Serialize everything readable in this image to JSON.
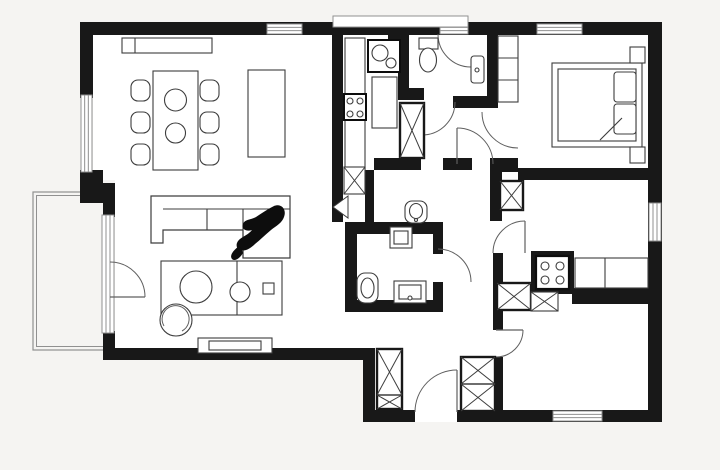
{
  "canvas": {
    "width": 720,
    "height": 470
  },
  "palette": {
    "bg": "#f5f4f2",
    "floor": "#ffffff",
    "wall": "#181818",
    "furn": "#3d3d3d",
    "glass": "#909090",
    "arc": "#5f5f5f",
    "white": "#ffffff",
    "black": "#0d0d0d",
    "none": "none"
  },
  "elements": [
    {
      "n": "floor",
      "t": "poly",
      "pts": "93,28 650,28 650,415 370,415 370,348 115,348 115,180 93,180",
      "f": "floor"
    },
    {
      "n": "balcony-outline",
      "t": "rect",
      "x": 33,
      "y": 192,
      "w": 79,
      "h": 158,
      "f": "none",
      "s": "glass",
      "sw": 1.2
    },
    {
      "n": "balcony-outline-inner",
      "t": "rect",
      "x": 36.5,
      "y": 195.5,
      "w": 72,
      "h": 151,
      "f": "none",
      "s": "glass",
      "sw": 1
    },
    {
      "n": "wall-top",
      "t": "wall",
      "x": 80,
      "y": 22,
      "w": 582,
      "h": 13
    },
    {
      "n": "wall-left-upper",
      "t": "wall",
      "x": 80,
      "y": 22,
      "w": 13,
      "h": 76
    },
    {
      "n": "wall-left-mid",
      "t": "wall",
      "x": 80,
      "y": 170,
      "w": 23,
      "h": 33
    },
    {
      "n": "wall-left-step",
      "t": "wall",
      "x": 103,
      "y": 183,
      "w": 12,
      "h": 34
    },
    {
      "n": "wall-left-lower",
      "t": "wall",
      "x": 103,
      "y": 331,
      "w": 12,
      "h": 29
    },
    {
      "n": "wall-bottom-living",
      "t": "wall",
      "x": 103,
      "y": 348,
      "w": 272,
      "h": 12
    },
    {
      "n": "wall-vestibule-west",
      "t": "wall",
      "x": 363,
      "y": 354,
      "w": 12,
      "h": 68
    },
    {
      "n": "wall-bottom",
      "t": "wall",
      "x": 363,
      "y": 410,
      "w": 299,
      "h": 12
    },
    {
      "n": "wall-right",
      "t": "wall",
      "x": 648,
      "y": 22,
      "w": 14,
      "h": 400
    },
    {
      "n": "wall-kitchen-west",
      "t": "wall",
      "x": 332,
      "y": 35,
      "w": 11,
      "h": 187
    },
    {
      "n": "wall-kitchen-stub",
      "t": "wall",
      "x": 388,
      "y": 28,
      "w": 10,
      "h": 26
    },
    {
      "n": "wall-kitchen-east",
      "t": "wall",
      "x": 398,
      "y": 35,
      "w": 11,
      "h": 65
    },
    {
      "n": "wall-bath1-south",
      "t": "wall",
      "x": 398,
      "y": 88,
      "w": 26,
      "h": 12
    },
    {
      "n": "wall-hall-mid",
      "t": "wall",
      "x": 453,
      "y": 96,
      "w": 34,
      "h": 12
    },
    {
      "n": "wall-bath1-east",
      "t": "wall",
      "x": 487,
      "y": 35,
      "w": 11,
      "h": 73
    },
    {
      "n": "wall-bedroom-jog",
      "t": "wall",
      "x": 490,
      "y": 158,
      "w": 28,
      "h": 14
    },
    {
      "n": "wall-hall-east",
      "t": "wall",
      "x": 490,
      "y": 168,
      "w": 12,
      "h": 53
    },
    {
      "n": "wall-bedroom-south",
      "t": "wall",
      "x": 518,
      "y": 168,
      "w": 130,
      "h": 12
    },
    {
      "n": "wall-kitchenette-west",
      "t": "wall",
      "x": 493,
      "y": 253,
      "w": 10,
      "h": 77
    },
    {
      "n": "wall-room2-west",
      "t": "wall",
      "x": 493,
      "y": 357,
      "w": 10,
      "h": 53
    },
    {
      "n": "wall-stove-block",
      "t": "wall",
      "x": 531,
      "y": 251,
      "w": 43,
      "h": 43
    },
    {
      "n": "wall-under-counter",
      "t": "wall",
      "x": 572,
      "y": 288,
      "w": 78,
      "h": 16
    },
    {
      "n": "wall-wc2-north-a",
      "t": "wall",
      "x": 374,
      "y": 158,
      "w": 47,
      "h": 12
    },
    {
      "n": "wall-wc2-north-b",
      "t": "wall",
      "x": 443,
      "y": 158,
      "w": 29,
      "h": 12
    },
    {
      "n": "wall-wc2-west",
      "t": "wall",
      "x": 365,
      "y": 170,
      "w": 9,
      "h": 52
    },
    {
      "n": "wall-bath2-north",
      "t": "wall",
      "x": 345,
      "y": 222,
      "w": 98,
      "h": 12
    },
    {
      "n": "wall-bath2-west",
      "t": "wall",
      "x": 345,
      "y": 222,
      "w": 12,
      "h": 90
    },
    {
      "n": "wall-bath2-south",
      "t": "wall",
      "x": 345,
      "y": 300,
      "w": 98,
      "h": 12
    },
    {
      "n": "wall-bath2-east-a",
      "t": "wall",
      "x": 433,
      "y": 234,
      "w": 10,
      "h": 20
    },
    {
      "n": "wall-bath2-east-b",
      "t": "wall",
      "x": 433,
      "y": 282,
      "w": 10,
      "h": 18
    },
    {
      "n": "entrance-door-gap",
      "t": "rect",
      "x": 415,
      "y": 410,
      "w": 42,
      "h": 12,
      "f": "floor",
      "s": "none"
    },
    {
      "n": "window-top-1",
      "t": "win",
      "x": 267,
      "y": 24,
      "w": 35,
      "h": 10,
      "o": "h"
    },
    {
      "n": "window-top-2",
      "t": "win",
      "x": 440,
      "y": 24,
      "w": 28,
      "h": 10,
      "o": "h"
    },
    {
      "n": "window-band",
      "t": "rect",
      "x": 333,
      "y": 16,
      "w": 135,
      "h": 11,
      "f": "white",
      "s": "glass",
      "sw": 1
    },
    {
      "n": "window-top-3",
      "t": "win",
      "x": 537,
      "y": 24,
      "w": 45,
      "h": 10,
      "o": "h"
    },
    {
      "n": "window-left",
      "t": "win",
      "x": 81,
      "y": 95,
      "w": 11,
      "h": 77,
      "o": "v"
    },
    {
      "n": "balcony-glass-door",
      "t": "win",
      "x": 102,
      "y": 215,
      "w": 12,
      "h": 118,
      "o": "v"
    },
    {
      "n": "window-right",
      "t": "win",
      "x": 649,
      "y": 203,
      "w": 12,
      "h": 38,
      "o": "v"
    },
    {
      "n": "window-bottom",
      "t": "win",
      "x": 553,
      "y": 411,
      "w": 49,
      "h": 10,
      "o": "h"
    },
    {
      "n": "balcony-door-arc",
      "t": "arc",
      "d": "M 145 297 A 35 35 0 0 0 110 262"
    },
    {
      "n": "balcony-door-leaf",
      "t": "leaf",
      "x1": 110,
      "y1": 297,
      "x2": 145,
      "y2": 297
    },
    {
      "n": "entrance-door-arc",
      "t": "arc",
      "d": "M 457 370 A 42 42 0 0 0 415 412"
    },
    {
      "n": "entrance-door-leaf",
      "t": "leaf",
      "x1": 457,
      "y1": 370,
      "x2": 457,
      "y2": 412
    },
    {
      "n": "bath1-door-arc",
      "t": "arc",
      "d": "M 438 34 A 33 33 0 0 0 471 67"
    },
    {
      "n": "hall-door-arc",
      "t": "arc",
      "d": "M 455 102 A 33 33 0 0 1 422 135"
    },
    {
      "n": "wc2-door-leaf",
      "t": "leaf",
      "x1": 457,
      "y1": 128,
      "x2": 457,
      "y2": 164
    },
    {
      "n": "wc2-door-arc",
      "t": "arc",
      "d": "M 457 128 A 36 36 0 0 1 493 164"
    },
    {
      "n": "bedroom-door-arc",
      "t": "arc",
      "d": "M 482 112 A 36 36 0 0 0 518 148"
    },
    {
      "n": "bath2-door-arc",
      "t": "arc",
      "d": "M 438 249 A 33 33 0 0 1 471 282"
    },
    {
      "n": "kitchenette-door-leaf",
      "t": "leaf",
      "x1": 525,
      "y1": 221,
      "x2": 525,
      "y2": 253
    },
    {
      "n": "kitchenette-door-arc",
      "t": "arc",
      "d": "M 525 221 A 32 32 0 0 0 493 253"
    },
    {
      "n": "room2-door-leaf",
      "t": "leaf",
      "x1": 496,
      "y1": 330,
      "x2": 523,
      "y2": 330
    },
    {
      "n": "room2-door-arc",
      "t": "arc",
      "d": "M 523 330 A 27 27 0 0 1 496 357"
    },
    {
      "n": "kitchen-pocket-door",
      "t": "path",
      "d": "M 348 196 L 333 207 L 348 218 Z",
      "f": "white",
      "s": "furn",
      "sw": 1
    },
    {
      "n": "sideboard",
      "t": "rect",
      "x": 122,
      "y": 38,
      "w": 90,
      "h": 15
    },
    {
      "n": "sideboard-divider",
      "t": "l",
      "x1": 135,
      "y1": 38,
      "x2": 135,
      "y2": 53
    },
    {
      "n": "dining-chair",
      "t": "rect",
      "x": 131,
      "y": 80,
      "w": 19,
      "h": 21,
      "rx": 7
    },
    {
      "n": "dining-chair",
      "t": "rect",
      "x": 131,
      "y": 112,
      "w": 19,
      "h": 21,
      "rx": 7
    },
    {
      "n": "dining-chair",
      "t": "rect",
      "x": 131,
      "y": 144,
      "w": 19,
      "h": 21,
      "rx": 7
    },
    {
      "n": "dining-chair",
      "t": "rect",
      "x": 200,
      "y": 80,
      "w": 19,
      "h": 21,
      "rx": 7
    },
    {
      "n": "dining-chair",
      "t": "rect",
      "x": 200,
      "y": 112,
      "w": 19,
      "h": 21,
      "rx": 7
    },
    {
      "n": "dining-chair",
      "t": "rect",
      "x": 200,
      "y": 144,
      "w": 19,
      "h": 21,
      "rx": 7
    },
    {
      "n": "dining-table",
      "t": "rect",
      "x": 153,
      "y": 71,
      "w": 45,
      "h": 99
    },
    {
      "n": "plate",
      "t": "c",
      "cx": 175.5,
      "cy": 100,
      "r": 11
    },
    {
      "n": "plate",
      "t": "c",
      "cx": 175.5,
      "cy": 133,
      "r": 10
    },
    {
      "n": "kitchen-island",
      "t": "rect",
      "x": 248,
      "y": 70,
      "w": 37,
      "h": 87
    },
    {
      "n": "kitchen-counter",
      "t": "rect",
      "x": 345,
      "y": 38,
      "w": 20,
      "h": 137
    },
    {
      "n": "cooktop",
      "t": "rect",
      "x": 344,
      "y": 94,
      "w": 22,
      "h": 26,
      "s": "black",
      "sw": 2
    },
    {
      "n": "burner",
      "t": "c",
      "cx": 350,
      "cy": 101,
      "r": 3
    },
    {
      "n": "burner",
      "t": "c",
      "cx": 360,
      "cy": 101,
      "r": 3
    },
    {
      "n": "burner",
      "t": "c",
      "cx": 350,
      "cy": 114,
      "r": 3
    },
    {
      "n": "burner",
      "t": "c",
      "cx": 360,
      "cy": 114,
      "r": 3
    },
    {
      "n": "kitchen-sink-unit",
      "t": "rect",
      "x": 368,
      "y": 40,
      "w": 32,
      "h": 32,
      "s": "black",
      "sw": 2
    },
    {
      "n": "sink-bowl",
      "t": "c",
      "cx": 380,
      "cy": 53,
      "r": 8
    },
    {
      "n": "sink-bowl",
      "t": "c",
      "cx": 391,
      "cy": 63,
      "r": 5
    },
    {
      "n": "tall-cabinet",
      "t": "rect",
      "x": 372,
      "y": 77,
      "w": 25,
      "h": 51
    },
    {
      "n": "dishwasher",
      "t": "xbox",
      "x": 344,
      "y": 167,
      "w": 21,
      "h": 27
    },
    {
      "n": "toilet-tank",
      "t": "rect",
      "x": 419,
      "y": 38,
      "w": 19,
      "h": 11
    },
    {
      "n": "toilet-bowl",
      "t": "e",
      "cx": 428,
      "cy": 60,
      "rx": 8.5,
      "ry": 12
    },
    {
      "n": "washbasin",
      "t": "rect",
      "x": 471,
      "y": 56,
      "w": 13,
      "h": 27,
      "rx": 3
    },
    {
      "n": "washbasin-drain",
      "t": "c",
      "cx": 477,
      "cy": 70,
      "r": 2
    },
    {
      "n": "hall-wardrobe",
      "t": "xbox",
      "x": 400,
      "y": 103,
      "w": 24,
      "h": 55,
      "bold": true
    },
    {
      "n": "bidet",
      "t": "rect",
      "x": 405,
      "y": 201,
      "w": 22,
      "h": 22,
      "rx": 7
    },
    {
      "n": "bidet-bowl",
      "t": "e",
      "cx": 416,
      "cy": 211,
      "rx": 6.5,
      "ry": 7.5
    },
    {
      "n": "bidet-tap",
      "t": "c",
      "cx": 416,
      "cy": 220,
      "r": 1.5
    },
    {
      "n": "washing-machine",
      "t": "rect",
      "x": 390,
      "y": 227,
      "w": 22,
      "h": 21
    },
    {
      "n": "washing-machine-door",
      "t": "rect",
      "x": 394,
      "y": 231,
      "w": 14,
      "h": 13
    },
    {
      "n": "toilet2",
      "t": "rect",
      "x": 357,
      "y": 273,
      "w": 21,
      "h": 30,
      "rx": 8
    },
    {
      "n": "toilet2-bowl",
      "t": "e",
      "cx": 367.5,
      "cy": 288,
      "rx": 6.5,
      "ry": 10
    },
    {
      "n": "bathroom-sink",
      "t": "rect",
      "x": 394,
      "y": 281,
      "w": 32,
      "h": 22
    },
    {
      "n": "bathroom-sink-basin",
      "t": "rect",
      "x": 399,
      "y": 285,
      "w": 22,
      "h": 14
    },
    {
      "n": "bathroom-sink-tap",
      "t": "c",
      "cx": 410,
      "cy": 298,
      "r": 2
    },
    {
      "n": "built-in-closet",
      "t": "rect",
      "x": 498,
      "y": 36,
      "w": 20,
      "h": 66
    },
    {
      "n": "closet-shelf",
      "t": "l",
      "x1": 498,
      "y1": 58,
      "x2": 518,
      "y2": 58
    },
    {
      "n": "closet-shelf",
      "t": "l",
      "x1": 498,
      "y1": 80,
      "x2": 518,
      "y2": 80
    },
    {
      "n": "double-bed",
      "t": "rect",
      "x": 552,
      "y": 63,
      "w": 90,
      "h": 84
    },
    {
      "n": "mattress",
      "t": "rect",
      "x": 558,
      "y": 69,
      "w": 78,
      "h": 72
    },
    {
      "n": "pillow",
      "t": "rect",
      "x": 614,
      "y": 72,
      "w": 22,
      "h": 30,
      "rx": 3
    },
    {
      "n": "pillow",
      "t": "rect",
      "x": 614,
      "y": 104,
      "w": 22,
      "h": 30,
      "rx": 3
    },
    {
      "n": "blanket-fold",
      "t": "l",
      "x1": 600,
      "y1": 140,
      "x2": 622,
      "y2": 118
    },
    {
      "n": "nightstand",
      "t": "rect",
      "x": 630,
      "y": 47,
      "w": 15,
      "h": 16
    },
    {
      "n": "nightstand",
      "t": "rect",
      "x": 630,
      "y": 147,
      "w": 15,
      "h": 16
    },
    {
      "n": "hall-cabinet",
      "t": "xbox",
      "x": 500,
      "y": 181,
      "w": 23,
      "h": 29,
      "bold": true
    },
    {
      "n": "kitchenette-cooktop",
      "t": "rect",
      "x": 536,
      "y": 256,
      "w": 33,
      "h": 33,
      "s": "black",
      "sw": 2.2
    },
    {
      "n": "burner",
      "t": "c",
      "cx": 545,
      "cy": 266,
      "r": 4
    },
    {
      "n": "burner",
      "t": "c",
      "cx": 560,
      "cy": 266,
      "r": 4
    },
    {
      "n": "burner",
      "t": "c",
      "cx": 545,
      "cy": 280,
      "r": 4
    },
    {
      "n": "burner",
      "t": "c",
      "cx": 560,
      "cy": 280,
      "r": 4
    },
    {
      "n": "kitchenette-counter",
      "t": "rect",
      "x": 575,
      "y": 258,
      "w": 73,
      "h": 30
    },
    {
      "n": "kitchenette-counter-divider",
      "t": "l",
      "x1": 605,
      "y1": 258,
      "x2": 605,
      "y2": 288
    },
    {
      "n": "kitchenette-cabinet",
      "t": "xbox",
      "x": 497,
      "y": 283,
      "w": 34,
      "h": 27,
      "bold": true
    },
    {
      "n": "kitchenette-cabinet-small",
      "t": "xbox",
      "x": 531,
      "y": 292,
      "w": 27,
      "h": 19
    },
    {
      "n": "entry-wardrobe",
      "t": "xbox",
      "x": 377,
      "y": 349,
      "w": 25,
      "h": 60,
      "bold": true,
      "divY": 395
    },
    {
      "n": "entry-wardrobe",
      "t": "xbox",
      "x": 461,
      "y": 357,
      "w": 34,
      "h": 54,
      "bold": true,
      "divY": 384
    },
    {
      "n": "sofa",
      "t": "path",
      "d": "M 151 196 H 290 V 258 H 243 V 230 H 163 V 243 H 151 Z",
      "f": "white",
      "s": "furn",
      "sw": 1.2
    },
    {
      "n": "sofa-back-line",
      "t": "l",
      "x1": 163,
      "y1": 209,
      "x2": 290,
      "y2": 209
    },
    {
      "n": "sofa-seat-divider",
      "t": "l",
      "x1": 207,
      "y1": 209,
      "x2": 207,
      "y2": 230
    },
    {
      "n": "sofa-seat-divider",
      "t": "l",
      "x1": 243,
      "y1": 209,
      "x2": 243,
      "y2": 258
    },
    {
      "n": "coffee-table",
      "t": "rect",
      "x": 161,
      "y": 261,
      "w": 121,
      "h": 54
    },
    {
      "n": "coffee-table-divider",
      "t": "l",
      "x1": 237,
      "y1": 261,
      "x2": 237,
      "y2": 315
    },
    {
      "n": "decor-tray",
      "t": "c",
      "cx": 196,
      "cy": 287,
      "r": 16
    },
    {
      "n": "decor-bowl",
      "t": "c",
      "cx": 240,
      "cy": 292,
      "r": 10
    },
    {
      "n": "decor-box",
      "t": "rect",
      "x": 263,
      "y": 283,
      "w": 11,
      "h": 11
    },
    {
      "n": "pouf",
      "t": "c",
      "cx": 176,
      "cy": 320,
      "r": 16
    },
    {
      "n": "pouf-swirl",
      "t": "arc",
      "d": "M 164 326 A 13.5 13.5 0 1 1 182 331"
    },
    {
      "n": "tv-stand",
      "t": "rect",
      "x": 198,
      "y": 338,
      "w": 74,
      "h": 15
    },
    {
      "n": "tv",
      "t": "rect",
      "x": 209,
      "y": 341,
      "w": 52,
      "h": 9
    },
    {
      "n": "person-figure",
      "t": "path",
      "d": "M 274 206 C 281 203 287 209 284 217 C 282 223 276 226 271 230 C 265 235 260 240 255 244 C 251 248 245 252 240 250 C 235 248 236 242 240 239 C 244 236 249 234 252 230 C 246 232 241 229 243 224 C 245 219 251 220 256 217 C 262 213 268 209 274 206 Z",
      "f": "black",
      "s": "none"
    },
    {
      "n": "person-figure-arm",
      "t": "path",
      "d": "M 239 246 C 234 250 229 255 232 259 C 235 262 240 258 243 253 C 242 250 241 247 239 246 Z",
      "f": "black",
      "s": "none"
    }
  ]
}
